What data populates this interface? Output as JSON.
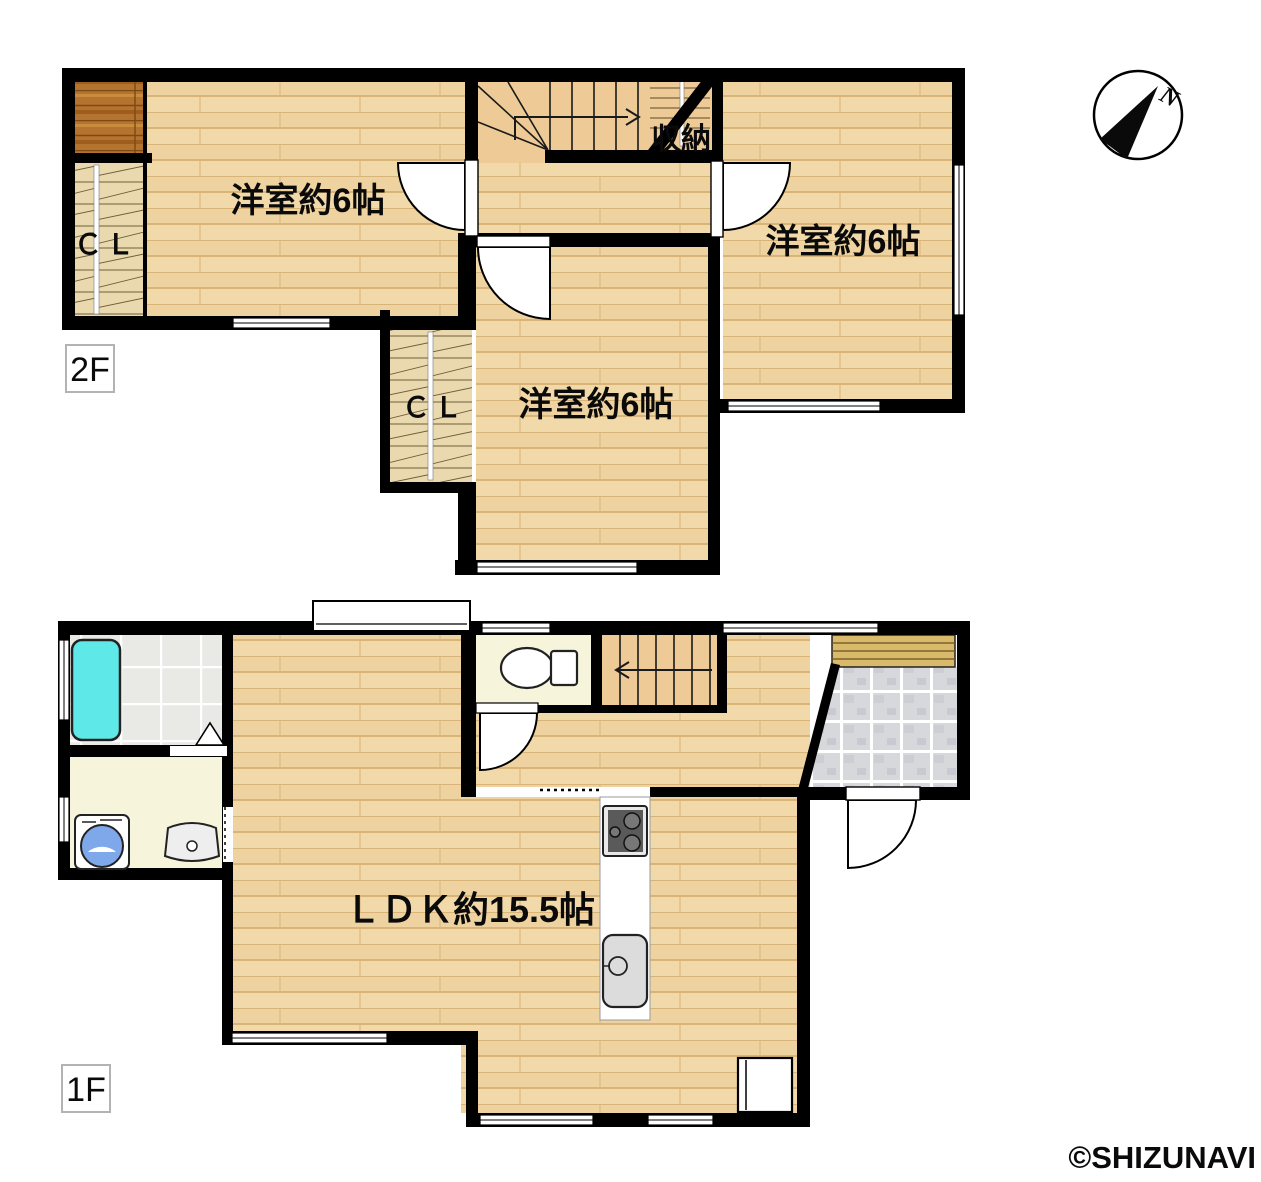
{
  "floor_plan": {
    "floor2": {
      "tag": "2F",
      "room_nw_label": "洋室約6帖",
      "room_ne_label": "洋室約6帖",
      "room_s_label": "洋室約6帖",
      "closet_nw_label": "ＣＬ",
      "closet_s_label": "ＣＬ",
      "storage_label": "収納"
    },
    "floor1": {
      "tag": "1F",
      "ldk_label": "ＬＤＫ約15.5帖"
    },
    "compass": {
      "north_label": "N"
    },
    "watermark": "©SHIZUNAVI"
  },
  "colors": {
    "wall": "#000000",
    "wood_floor": "#f1d7a7",
    "stair_floor": "#edca96",
    "dark_wood": "#b4732e",
    "closet_floor": "#ead9ae",
    "cream_floor": "#f7f4dc",
    "bath_tile": "#e9e9e6",
    "entry_tile": "#d7d8db",
    "bathtub": "#5fe8e8",
    "washer_lid": "#7fa8ea",
    "shoe_cabinet": "#d9b96a",
    "watermark_gray": "#3f3f3f"
  }
}
